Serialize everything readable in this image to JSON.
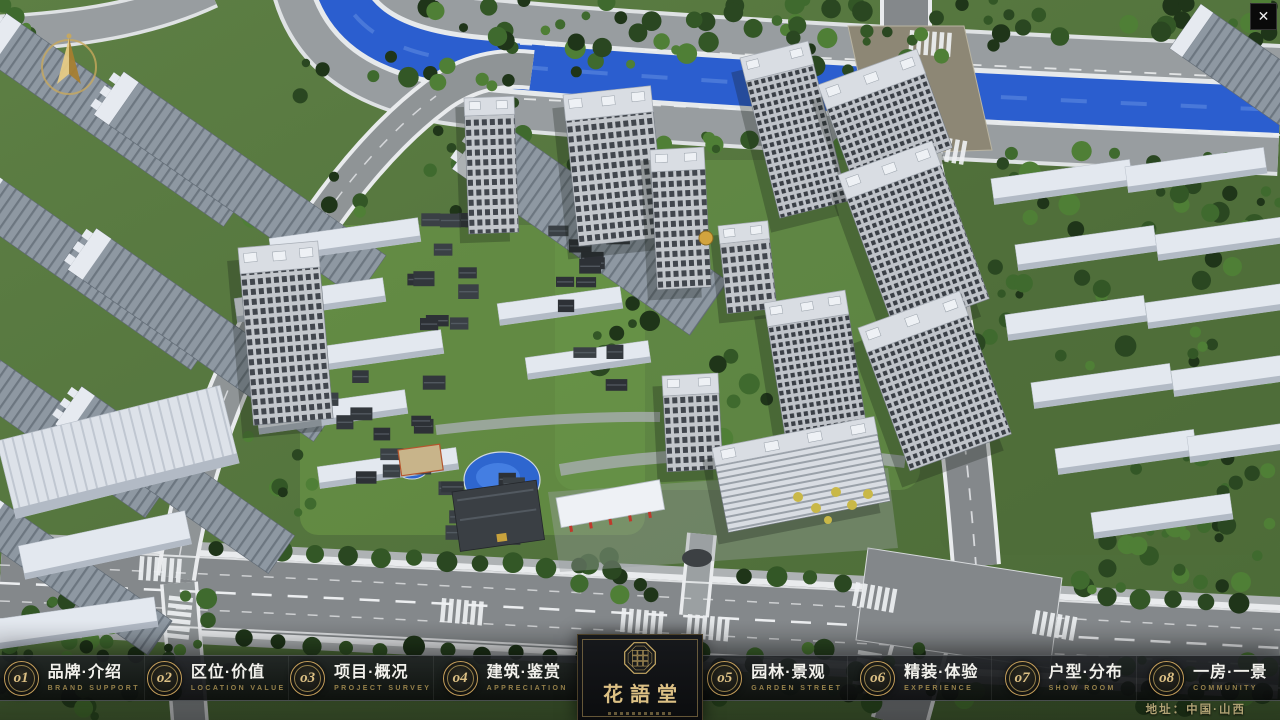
{
  "colors": {
    "gold": "#c49e5a",
    "gold-bright": "#dcc084",
    "gold-dim": "#95804a",
    "tan": "#b0a274",
    "text": "#f2f1ec",
    "river": "#2b5ecf"
  },
  "window": {
    "close_glyph": "✕"
  },
  "nav": {
    "items": [
      {
        "num": "o1",
        "zh": "品牌·介绍",
        "en": "BRAND SUPPORT"
      },
      {
        "num": "o2",
        "zh": "区位·价值",
        "en": "LOCATION VALUE"
      },
      {
        "num": "o3",
        "zh": "项目·概况",
        "en": "PROJECT SURVEY"
      },
      {
        "num": "o4",
        "zh": "建筑·鉴赏",
        "en": "APPRECIATION"
      },
      {
        "num": "o5",
        "zh": "园林·景观",
        "en": "GARDEN STREET"
      },
      {
        "num": "o6",
        "zh": "精装·体验",
        "en": "EXPERIENCE"
      },
      {
        "num": "o7",
        "zh": "户型·分布",
        "en": "SHOW ROOM"
      },
      {
        "num": "o8",
        "zh": "一房·一景",
        "en": "COMMUNITY"
      }
    ]
  },
  "logo": {
    "title": "花語堂"
  },
  "footer": {
    "address": "地址：中国·山西"
  }
}
